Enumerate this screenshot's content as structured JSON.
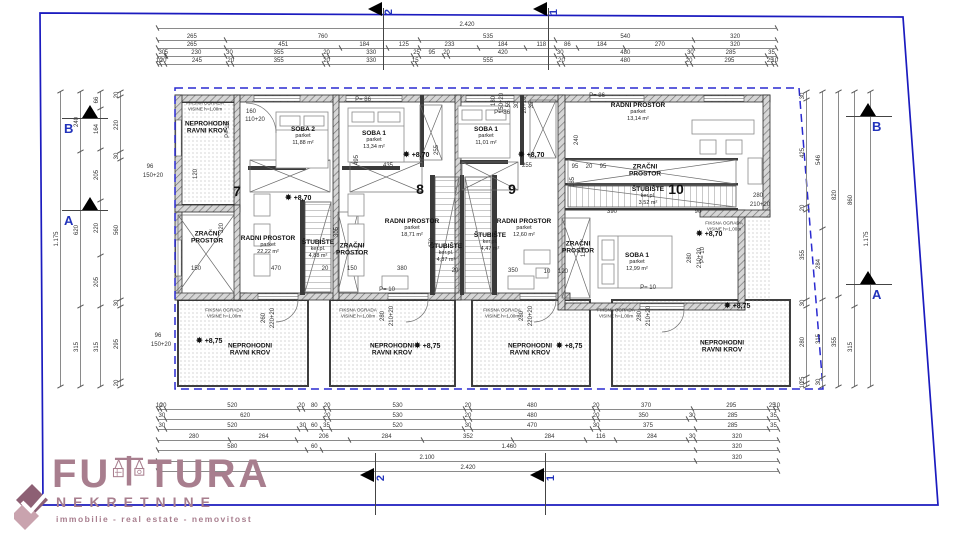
{
  "colors": {
    "boundary_blue": "#1b1bbf",
    "envelope_blue": "#2a2ad0",
    "marker_blue": "#2233bb",
    "logo_mauve": "#a87e8e",
    "line_dark": "#2e2e2e"
  },
  "logo": {
    "word": "FUTURA",
    "sub": "NEKRETNINE",
    "tagline": "immobilie - real estate - nemovitost"
  },
  "sections": [
    {
      "t": "2",
      "x": 383,
      "side": "top"
    },
    {
      "t": "1",
      "x": 548,
      "side": "top"
    },
    {
      "t": "2",
      "x": 375,
      "side": "bottom"
    },
    {
      "t": "1",
      "x": 545,
      "side": "bottom"
    }
  ],
  "letters": [
    {
      "t": "B",
      "x": 62,
      "y": 118,
      "side": "left"
    },
    {
      "t": "A",
      "x": 62,
      "y": 210,
      "side": "left"
    },
    {
      "t": "B",
      "x": 846,
      "y": 116,
      "side": "right"
    },
    {
      "t": "A",
      "x": 846,
      "y": 284,
      "side": "right"
    }
  ],
  "dims": {
    "h": [
      {
        "y": 28,
        "x1": 158,
        "x2": 776,
        "parts": [
          [
            2420,
            "2.420"
          ]
        ]
      },
      {
        "y": 40,
        "x1": 158,
        "x2": 776,
        "parts": [
          [
            265
          ],
          [
            760
          ],
          [
            535
          ],
          [
            540
          ],
          [
            320
          ]
        ]
      },
      {
        "y": 48,
        "x1": 158,
        "x2": 776,
        "parts": [
          [
            265
          ],
          [
            451
          ],
          [
            184
          ],
          [
            125
          ],
          [
            233
          ],
          [
            184
          ],
          [
            118
          ],
          [
            86
          ],
          [
            184
          ],
          [
            270
          ],
          [
            320
          ]
        ]
      },
      {
        "y": 56,
        "x1": 158,
        "x2": 776,
        "parts": [
          [
            30
          ],
          [
            5
          ],
          [
            230
          ],
          [
            30
          ],
          [
            355
          ],
          [
            20
          ],
          [
            330
          ],
          [
            25
          ],
          [
            95
          ],
          [
            20
          ],
          [
            420
          ],
          [
            30
          ],
          [
            480
          ],
          [
            30
          ],
          [
            285
          ],
          [
            35
          ]
        ]
      },
      {
        "y": 64,
        "x1": 158,
        "x2": 776,
        "parts": [
          [
            10
          ],
          [
            20
          ],
          [
            245
          ],
          [
            20
          ],
          [
            355
          ],
          [
            20
          ],
          [
            330
          ],
          [
            15
          ],
          [
            555
          ],
          [
            20
          ],
          [
            480
          ],
          [
            20
          ],
          [
            295
          ],
          [
            25
          ],
          [
            10
          ]
        ]
      },
      {
        "y": 409,
        "x1": 158,
        "x2": 778,
        "parts": [
          [
            10
          ],
          [
            20
          ],
          [
            520
          ],
          [
            20
          ],
          [
            80
          ],
          [
            20
          ],
          [
            530
          ],
          [
            20
          ],
          [
            480
          ],
          [
            20
          ],
          [
            370
          ],
          [
            295
          ],
          [
            25
          ],
          [
            10
          ]
        ]
      },
      {
        "y": 419,
        "x1": 158,
        "x2": 778,
        "parts": [
          [
            30
          ],
          [
            620
          ],
          [
            20
          ],
          [
            530
          ],
          [
            20
          ],
          [
            480
          ],
          [
            20
          ],
          [
            350
          ],
          [
            30
          ],
          [
            285
          ],
          [
            35
          ]
        ]
      },
      {
        "y": 429,
        "x1": 158,
        "x2": 778,
        "parts": [
          [
            30
          ],
          [
            520
          ],
          [
            30
          ],
          [
            60
          ],
          [
            35
          ],
          [
            520
          ],
          [
            30
          ],
          [
            470
          ],
          [
            30
          ],
          [
            375
          ],
          [
            285
          ],
          [
            35
          ]
        ]
      },
      {
        "y": 440,
        "x1": 158,
        "x2": 778,
        "parts": [
          [
            280
          ],
          [
            264
          ],
          [
            206
          ],
          [
            284
          ],
          [
            352
          ],
          [
            284
          ],
          [
            116
          ],
          [
            284
          ],
          [
            30
          ],
          [
            320
          ]
        ]
      },
      {
        "y": 450,
        "x1": 158,
        "x2": 778,
        "parts": [
          [
            580
          ],
          [
            60
          ],
          [
            1460,
            "1.460"
          ],
          [
            320
          ]
        ]
      },
      {
        "y": 461,
        "x1": 158,
        "x2": 778,
        "parts": [
          [
            2100,
            "2.100"
          ],
          [
            320
          ]
        ]
      },
      {
        "y": 471,
        "x1": 158,
        "x2": 778,
        "parts": [
          [
            2420,
            "2.420"
          ]
        ]
      }
    ],
    "v": [
      {
        "x": 60,
        "y1": 92,
        "y2": 386,
        "parts": [
          [
            1175,
            "1.175"
          ]
        ]
      },
      {
        "x": 80,
        "y1": 92,
        "y2": 386,
        "parts": [
          [
            240
          ],
          [
            620
          ],
          [
            315
          ]
        ]
      },
      {
        "x": 100,
        "y1": 92,
        "y2": 386,
        "parts": [
          [
            66
          ],
          [
            164
          ],
          [
            205
          ],
          [
            220
          ],
          [
            205
          ],
          [
            315
          ]
        ]
      },
      {
        "x": 120,
        "y1": 92,
        "y2": 386,
        "parts": [
          [
            20
          ],
          [
            220
          ],
          [
            30
          ],
          [
            560
          ],
          [
            30
          ],
          [
            295
          ],
          [
            20
          ]
        ]
      },
      {
        "x": 806,
        "y1": 92,
        "y2": 386,
        "parts": [
          [
            30
          ],
          [
            425
          ],
          [
            20
          ],
          [
            355
          ],
          [
            30
          ],
          [
            280
          ],
          [
            25
          ],
          [
            10
          ]
        ]
      },
      {
        "x": 822,
        "y1": 92,
        "y2": 386,
        "parts": [
          [
            546
          ],
          [
            284
          ],
          [
            315
          ],
          [
            30
          ]
        ]
      },
      {
        "x": 838,
        "y1": 92,
        "y2": 386,
        "parts": [
          [
            820
          ],
          [
            355
          ]
        ]
      },
      {
        "x": 854,
        "y1": 92,
        "y2": 386,
        "parts": [
          [
            860
          ],
          [
            315
          ]
        ]
      },
      {
        "x": 870,
        "y1": 92,
        "y2": 386,
        "parts": [
          [
            1175,
            "1.175"
          ]
        ]
      }
    ]
  },
  "units": [
    {
      "n": "7",
      "x": 237,
      "y": 191
    },
    {
      "n": "8",
      "x": 420,
      "y": 189
    },
    {
      "n": "9",
      "x": 512,
      "y": 189
    },
    {
      "n": "10",
      "x": 676,
      "y": 189
    }
  ],
  "rooms": [
    {
      "x": 207,
      "y": 128,
      "l1": "NEPROHODNI",
      "l2": "RAVNI KROV"
    },
    {
      "x": 303,
      "y": 136,
      "l1": "SOBA 2",
      "sub": "parket",
      "area": "11,88 m²"
    },
    {
      "x": 374,
      "y": 140,
      "l1": "SOBA 1",
      "sub": "parket",
      "area": "13,34 m²"
    },
    {
      "x": 486,
      "y": 136,
      "l1": "SOBA 1",
      "sub": "parket",
      "area": "11,01 m²"
    },
    {
      "x": 638,
      "y": 112,
      "l1": "RADNI PROSTOR",
      "sub": "parket",
      "area": "13,14 m²"
    },
    {
      "x": 645,
      "y": 171,
      "l1": "ZRAČNI",
      "l2": "PROSTOR"
    },
    {
      "x": 648,
      "y": 196,
      "l1": "ŠTUBIŠTE",
      "sub": "ker.pl.",
      "area": "3,52 m²"
    },
    {
      "x": 207,
      "y": 238,
      "l1": "ZRAČNI",
      "l2": "PROSTOR"
    },
    {
      "x": 268,
      "y": 245,
      "l1": "RADNI PROSTOR",
      "sub": "parket",
      "area": "22,22 m²"
    },
    {
      "x": 318,
      "y": 249,
      "l1": "ŠTUBIŠTE",
      "sub": "ker.pl.",
      "area": "4,88 m²"
    },
    {
      "x": 352,
      "y": 250,
      "l1": "ZRAČNI",
      "l2": "PROSTOR"
    },
    {
      "x": 412,
      "y": 228,
      "l1": "RADNI PROSTOR",
      "sub": "parket",
      "area": "18,71 m²"
    },
    {
      "x": 446,
      "y": 253,
      "l1": "ŠTUBIŠTE",
      "sub": "ker.pl.",
      "area": "4,87 m²"
    },
    {
      "x": 490,
      "y": 242,
      "l1": "ŠTUBIŠTE",
      "sub": "ker.pl.",
      "area": "4,47 m²"
    },
    {
      "x": 524,
      "y": 228,
      "l1": "RADNI PROSTOR",
      "sub": "parket",
      "area": "12,60 m²"
    },
    {
      "x": 578,
      "y": 248,
      "l1": "ZRAČNI",
      "l2": "PROSTOR"
    },
    {
      "x": 637,
      "y": 262,
      "l1": "SOBA 1",
      "sub": "parket",
      "area": "12,99 m²"
    },
    {
      "x": 250,
      "y": 350,
      "l1": "NEPROHODNI",
      "l2": "RAVNI KROV"
    },
    {
      "x": 392,
      "y": 350,
      "l1": "NEPROHODNI",
      "l2": "RAVNI KROV"
    },
    {
      "x": 530,
      "y": 350,
      "l1": "NEPROHODNI",
      "l2": "RAVNI KROV"
    },
    {
      "x": 722,
      "y": 347,
      "l1": "NEPROHODNI",
      "l2": "RAVNI KROV"
    }
  ],
  "fence_notes": [
    {
      "l1": "FIKSNA OGRADA",
      "l2": "VISINE h=1,00m",
      "x": 205,
      "y": 106
    },
    {
      "l1": "FIKSNA OGRADA",
      "l2": "VISINE h=1,00m",
      "x": 224,
      "y": 313
    },
    {
      "l1": "FIKSNA OGRADA",
      "l2": "VISINE h=1,00m",
      "x": 358,
      "y": 313
    },
    {
      "l1": "FIKSNA OGRADA",
      "l2": "VISINE h=1,00m",
      "x": 502,
      "y": 313
    },
    {
      "l1": "FIKSNA OGRADA",
      "l2": "VISINE h=1,00m",
      "x": 616,
      "y": 313
    },
    {
      "l1": "FIKSNA OGRADA",
      "l2": "VISINE h=1,00m",
      "x": 724,
      "y": 226
    }
  ],
  "elevations": [
    {
      "t": "+8,70",
      "x": 285,
      "y": 193
    },
    {
      "t": "+8,70",
      "x": 403,
      "y": 150
    },
    {
      "t": "+8,70",
      "x": 518,
      "y": 150
    },
    {
      "t": "+8,70",
      "x": 696,
      "y": 229
    },
    {
      "t": "+8,75",
      "x": 196,
      "y": 336
    },
    {
      "t": "+8,75",
      "x": 414,
      "y": 341
    },
    {
      "t": "+8,75",
      "x": 556,
      "y": 341
    },
    {
      "t": "+8,75",
      "x": 724,
      "y": 301
    }
  ],
  "annotations": [
    {
      "t": "150",
      "x": 196,
      "y": 269
    },
    {
      "t": "470",
      "x": 276,
      "y": 269
    },
    {
      "t": "20",
      "x": 325,
      "y": 269
    },
    {
      "t": "150",
      "x": 352,
      "y": 269
    },
    {
      "t": "380",
      "x": 402,
      "y": 269
    },
    {
      "t": "20",
      "x": 455,
      "y": 271
    },
    {
      "t": "350",
      "x": 513,
      "y": 271
    },
    {
      "t": "10",
      "x": 547,
      "y": 272
    },
    {
      "t": "120",
      "x": 563,
      "y": 272
    },
    {
      "t": "390",
      "x": 612,
      "y": 212
    },
    {
      "t": "90",
      "x": 698,
      "y": 212
    },
    {
      "t": "435",
      "x": 388,
      "y": 166
    },
    {
      "t": "255",
      "x": 527,
      "y": 166
    },
    {
      "t": "95",
      "x": 575,
      "y": 167
    },
    {
      "t": "20",
      "x": 589,
      "y": 167
    },
    {
      "t": "95",
      "x": 603,
      "y": 167
    },
    {
      "t": "495",
      "x": 357,
      "y": 160,
      "r": -90
    },
    {
      "t": "255",
      "x": 437,
      "y": 150,
      "r": -90
    },
    {
      "t": "240",
      "x": 577,
      "y": 140,
      "r": -90
    },
    {
      "t": "185",
      "x": 573,
      "y": 182,
      "r": -90
    },
    {
      "t": "305",
      "x": 337,
      "y": 232,
      "r": -90
    },
    {
      "t": "320",
      "x": 222,
      "y": 228,
      "r": -90
    },
    {
      "t": "120",
      "x": 196,
      "y": 174,
      "r": -90
    },
    {
      "t": "470",
      "x": 432,
      "y": 243,
      "r": -90
    },
    {
      "t": "120",
      "x": 584,
      "y": 252,
      "r": -90
    },
    {
      "t": "160",
      "x": 251,
      "y": 112
    },
    {
      "t": "110+20",
      "x": 255,
      "y": 120
    },
    {
      "t": "180",
      "x": 494,
      "y": 101,
      "r": -90
    },
    {
      "t": "150+20",
      "x": 502,
      "y": 103,
      "r": -90
    },
    {
      "t": "55",
      "x": 509,
      "y": 104,
      "r": -90
    },
    {
      "t": "30",
      "x": 517,
      "y": 105,
      "r": -90
    },
    {
      "t": "20+10",
      "x": 525,
      "y": 105,
      "r": -90
    },
    {
      "t": "35",
      "x": 532,
      "y": 105,
      "r": -90
    },
    {
      "t": "96",
      "x": 150,
      "y": 167
    },
    {
      "t": "150+20",
      "x": 153,
      "y": 176
    },
    {
      "t": "96",
      "x": 158,
      "y": 336
    },
    {
      "t": "150+20",
      "x": 161,
      "y": 345
    },
    {
      "t": "260",
      "x": 264,
      "y": 318,
      "r": -90
    },
    {
      "t": "220+20",
      "x": 273,
      "y": 318,
      "r": -90
    },
    {
      "t": "280",
      "x": 383,
      "y": 316,
      "r": -90
    },
    {
      "t": "210+20",
      "x": 392,
      "y": 316,
      "r": -90
    },
    {
      "t": "280",
      "x": 522,
      "y": 316,
      "r": -90
    },
    {
      "t": "220+20",
      "x": 531,
      "y": 316,
      "r": -90
    },
    {
      "t": "280",
      "x": 640,
      "y": 316,
      "r": -90
    },
    {
      "t": "210+20",
      "x": 649,
      "y": 316,
      "r": -90
    },
    {
      "t": "280",
      "x": 758,
      "y": 196
    },
    {
      "t": "210+20",
      "x": 760,
      "y": 205
    },
    {
      "t": "280",
      "x": 690,
      "y": 258,
      "r": -90
    },
    {
      "t": "210+20",
      "x": 700,
      "y": 258,
      "r": -90
    },
    {
      "t": "P= 10",
      "x": 228,
      "y": 130,
      "r": -90
    },
    {
      "t": "P= 10",
      "x": 387,
      "y": 290
    },
    {
      "t": "P= 10",
      "x": 648,
      "y": 288
    },
    {
      "t": "P= 10",
      "x": 703,
      "y": 255,
      "r": -90
    },
    {
      "t": "P= 86",
      "x": 363,
      "y": 100
    },
    {
      "t": "P= 86",
      "x": 502,
      "y": 113
    },
    {
      "t": "P= 86",
      "x": 597,
      "y": 96
    }
  ]
}
